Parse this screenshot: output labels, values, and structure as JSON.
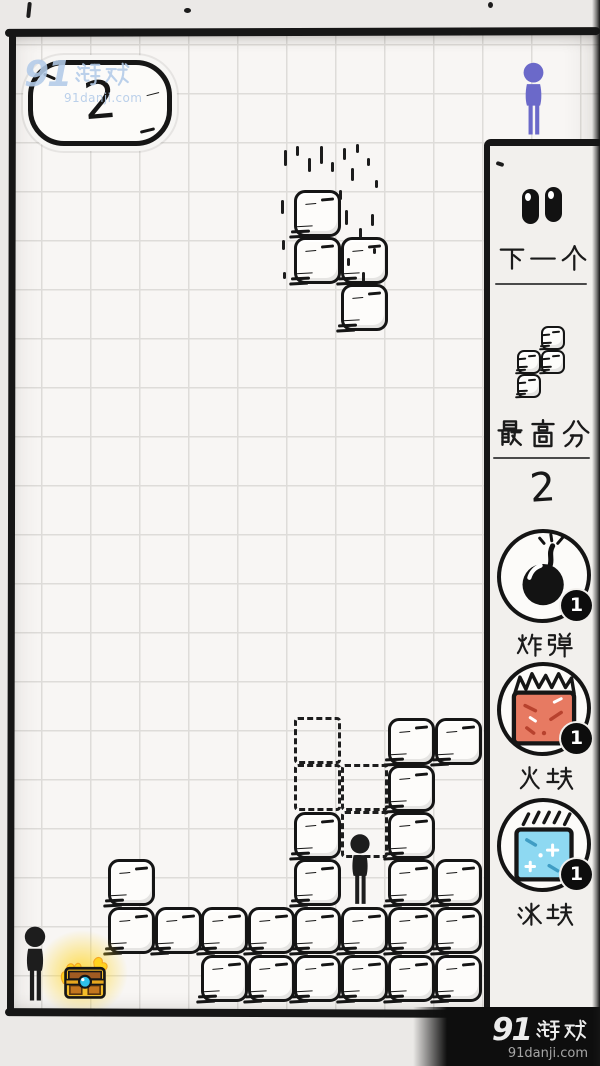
{
  "hud": {
    "score": "2"
  },
  "watermark_top": {
    "logo": "91游戏",
    "site": "91danji.com"
  },
  "watermark_bottom": {
    "logo": "91游戏",
    "site": "91danji.com"
  },
  "panel": {
    "pause_icon": "eyes-icon",
    "next_label": "下一个",
    "best_label": "最高分",
    "best_score": "2",
    "items": [
      {
        "id": "bomb",
        "icon": "bomb-icon",
        "label": "炸弹",
        "count": "1"
      },
      {
        "id": "fire",
        "icon": "fire-block-icon",
        "label": "火块",
        "count": "1"
      },
      {
        "id": "ice",
        "icon": "ice-block-icon",
        "label": "冰块",
        "count": "1"
      }
    ]
  },
  "board": {
    "cols_x": [
      14,
      61,
      108,
      155,
      201,
      248,
      294,
      341,
      388,
      435
    ],
    "rows_y": [
      718,
      765,
      812,
      859,
      907,
      955
    ],
    "cell": 47,
    "falling_piece": {
      "cells": [
        [
          6,
          0
        ],
        [
          6,
          1
        ],
        [
          7,
          1
        ],
        [
          7,
          2
        ]
      ],
      "y_origin": 190
    },
    "ghost_piece": {
      "cells": [
        [
          6,
          0
        ],
        [
          6,
          1
        ],
        [
          7,
          1
        ],
        [
          7,
          2
        ]
      ],
      "y_origin": 717
    },
    "stack": [
      [
        8,
        0
      ],
      [
        9,
        0
      ],
      [
        8,
        1
      ],
      [
        6,
        2
      ],
      [
        8,
        2
      ],
      [
        2,
        3
      ],
      [
        6,
        3
      ],
      [
        8,
        3
      ],
      [
        9,
        3
      ],
      [
        2,
        4
      ],
      [
        3,
        4
      ],
      [
        4,
        4
      ],
      [
        5,
        4
      ],
      [
        6,
        4
      ],
      [
        7,
        4
      ],
      [
        8,
        4
      ],
      [
        9,
        4
      ],
      [
        4,
        5
      ],
      [
        5,
        5
      ],
      [
        6,
        5
      ],
      [
        7,
        5
      ],
      [
        8,
        5
      ],
      [
        9,
        5
      ]
    ],
    "preview": {
      "cells": [
        [
          1,
          0
        ],
        [
          0,
          1
        ],
        [
          1,
          1
        ],
        [
          0,
          2
        ]
      ],
      "cell": 24
    },
    "actors": [
      {
        "id": "stickman-left",
        "color": "black"
      },
      {
        "id": "stickman-middle",
        "color": "black"
      },
      {
        "id": "stickman-top-right",
        "color": "purple"
      }
    ],
    "chest": {
      "id": "treasure-chest"
    }
  },
  "colors": {
    "figure_purple": "#6b69c9",
    "fire_block": "#e77a62",
    "ice_block": "#8ed9f2",
    "chest_gold": "#f3bd2a",
    "gem_blue": "#2fc0ea",
    "watermark_blue": "#b3cbe9",
    "ink": "#161616",
    "paper": "#f8f6f4",
    "panel_bg": "#f2f0ed"
  }
}
